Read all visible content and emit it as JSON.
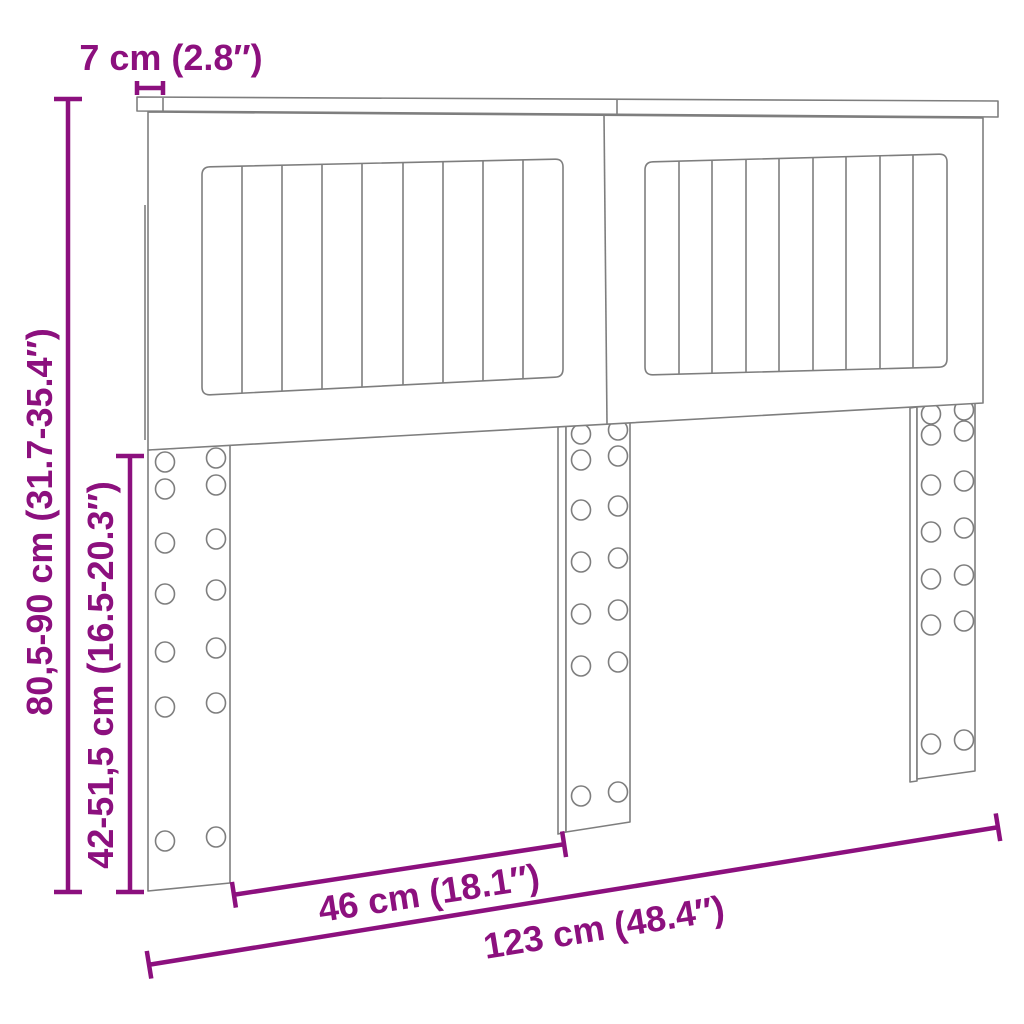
{
  "diagram": {
    "labels": {
      "top_thickness": "7 cm (2.8″)",
      "total_height": "80,5-90 cm (31.7-35.4″)",
      "leg_height": "42-51,5 cm (16.5-20.3″)",
      "leg_spacing": "46 cm (18.1″)",
      "total_width": "123 cm (48.4″)"
    },
    "colors": {
      "dimension": "#8c107e",
      "outline": "#7e7e7e",
      "background": "#ffffff"
    }
  }
}
